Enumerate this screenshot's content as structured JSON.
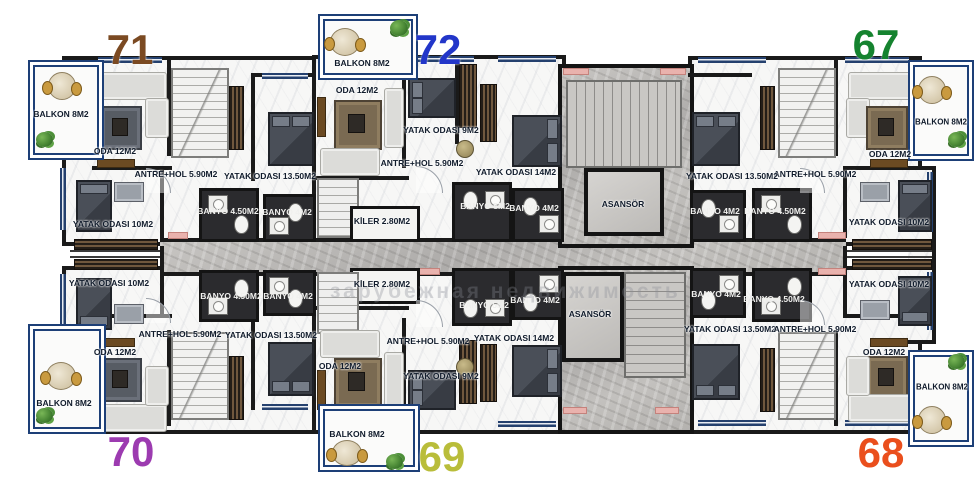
{
  "watermark": "зарубежная недвижимость",
  "core": {
    "asansor_top": "ASANSÖR",
    "asansor_bottom": "ASANSÖR"
  },
  "apartments": {
    "a71": {
      "number": "71",
      "number_color": "#7b4a22",
      "balkon": "BALKON 8M2",
      "oda": "ODA 12M2",
      "antre": "ANTRE+HOL 5.90M2",
      "yatak_buyuk": "YATAK ODASI 13.50M2",
      "banyo_buyuk": "BANYO 4.50M2",
      "banyo_kucuk": "BANYO 4M2",
      "yatak_kucuk": "YATAK ODASI 10M2"
    },
    "a72": {
      "number": "72",
      "number_color": "#2236c9",
      "balkon": "BALKON 8M2",
      "oda": "ODA 12M2",
      "yatak_kucuk": "YATAK ODASI 9M2",
      "antre": "ANTRE+HOL 5.90M2",
      "yatak_buyuk": "YATAK ODASI 14M2",
      "banyo_buyuk": "BANYO 5M2",
      "banyo_kucuk": "BANYO 4M2",
      "kiler": "KİLER 2.80M2"
    },
    "a67": {
      "number": "67",
      "number_color": "#15832f",
      "balkon": "BALKON 8M2",
      "oda": "ODA 12M2",
      "antre": "ANTRE+HOL 5.90M2",
      "yatak_buyuk": "YATAK ODASI 13.50M2",
      "banyo_buyuk": "BANYO 4.50M2",
      "banyo_kucuk": "BANYO 4M2",
      "yatak_kucuk": "YATAK ODASI 10M2"
    },
    "a70": {
      "number": "70",
      "number_color": "#9c3bb0",
      "balkon": "BALKON 8M2",
      "oda": "ODA 12M2",
      "antre": "ANTRE+HOL 5.90M2",
      "yatak_buyuk": "YATAK ODASI 13.50M2",
      "banyo_buyuk": "BANYO 4.50M2",
      "banyo_kucuk": "BANYO 4M2",
      "yatak_kucuk": "YATAK ODASI 10M2"
    },
    "a69": {
      "number": "69",
      "number_color": "#b9bd3a",
      "balkon": "BALKON 8M2",
      "oda": "ODA 12M2",
      "yatak_kucuk": "YATAK ODASI 9M2",
      "antre": "ANTRE+HOL 5.90M2",
      "yatak_buyuk": "YATAK ODASI 14M2",
      "banyo_buyuk": "BANYO 5M2",
      "banyo_kucuk": "BANYO 4M2",
      "kiler": "KİLER 2.80M2"
    },
    "a68": {
      "number": "68",
      "number_color": "#ea4f1d",
      "balkon": "BALKON 8M2",
      "oda": "ODA 12M2",
      "antre": "ANTRE+HOL 5.90M2",
      "yatak_buyuk": "YATAK ODASI 13.50M2",
      "banyo_buyuk": "BANYO 4.50M2",
      "banyo_kucuk": "BANYO 4M2",
      "yatak_kucuk": "YATAK ODASI 10M2"
    }
  }
}
